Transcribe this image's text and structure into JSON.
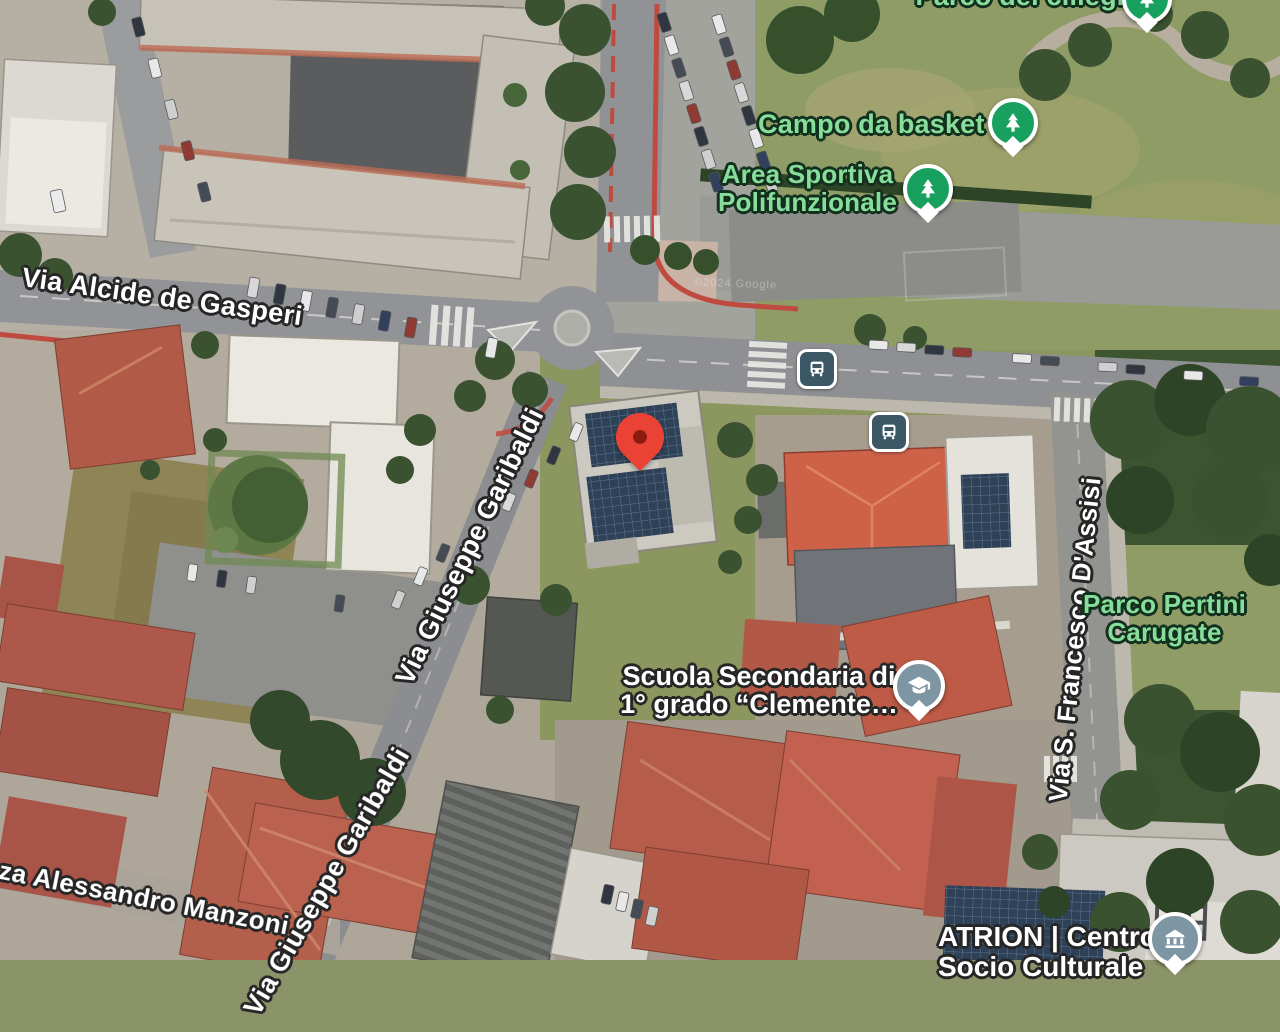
{
  "map": {
    "view": "satellite",
    "watermark": "©2024 Google",
    "colors": {
      "park_label": "#87DE9B",
      "road_label": "#FFFFFF",
      "poi_pin_green": "#17A05E",
      "poi_pin_slate": "#7E96A3",
      "bus_badge": "#3C5866",
      "marker_red": "#EA4335"
    },
    "marker": {
      "name": "dropped-pin",
      "color": "#EA4335"
    },
    "road_labels": [
      {
        "id": "gasperi",
        "text": "Via Alcide de Gasperi"
      },
      {
        "id": "garibaldi_upper",
        "text": "Via Giuseppe Garibaldi"
      },
      {
        "id": "garibaldi_lower",
        "text": "Via Giuseppe Garibaldi"
      },
      {
        "id": "assisi",
        "text": "Via S. Francesco D'Assisi"
      },
      {
        "id": "manzoni",
        "text": "zza Alessandro Manzoni"
      }
    ],
    "poi_labels": [
      {
        "id": "parco_top",
        "text": "Parco dei ciliegi",
        "type": "park",
        "icon": "tree-pin-icon"
      },
      {
        "id": "campo_basket",
        "text": "Campo da basket",
        "type": "park",
        "icon": "tree-pin-icon"
      },
      {
        "id": "area_sportiva",
        "line1": "Area Sportiva",
        "line2": "Polifunzionale",
        "type": "park",
        "icon": "tree-pin-icon"
      },
      {
        "id": "parco_pertini",
        "line1": "Parco Pertini",
        "line2": "Carugate",
        "type": "park"
      },
      {
        "id": "scuola",
        "line1": "Scuola Secondaria di",
        "line2": "1° grado “Clemente…",
        "type": "school",
        "icon": "school-pin-icon"
      },
      {
        "id": "atrion",
        "line1": "ATRION | Centro",
        "line2": "Socio Culturale",
        "type": "culture",
        "icon": "museum-pin-icon"
      }
    ],
    "transit": [
      {
        "id": "bus_stop_1",
        "icon": "bus-stop-icon"
      },
      {
        "id": "bus_stop_2",
        "icon": "bus-stop-icon"
      }
    ]
  }
}
